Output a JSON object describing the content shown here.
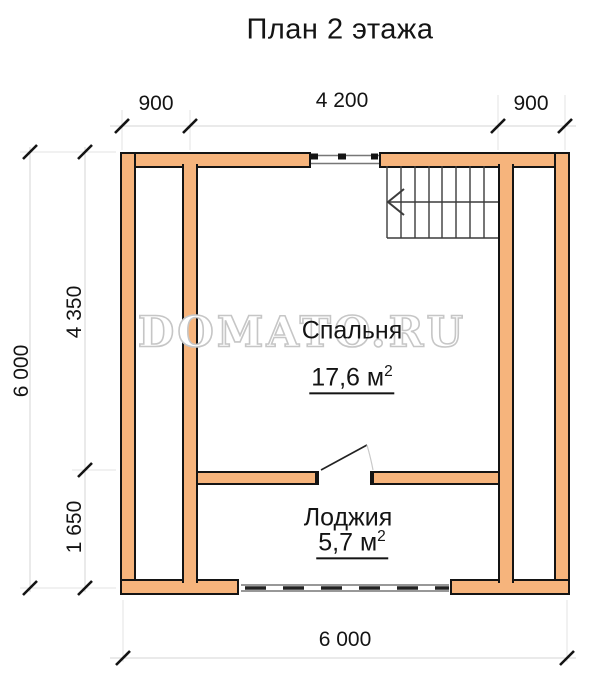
{
  "title": "План 2 этажа",
  "watermark": "DOMATO.RU",
  "plan": {
    "rooms": [
      {
        "name": "Спальня",
        "area": "17,6 м",
        "area_sup": "2"
      },
      {
        "name": "Лоджия",
        "area": "5,7 м",
        "area_sup": "2"
      }
    ],
    "dimensions": {
      "top_left": "900",
      "top_middle": "4 200",
      "top_right": "900",
      "left_total": "6 000",
      "left_upper": "4 350",
      "left_lower": "1 650",
      "bottom_total": "6 000"
    }
  },
  "colors": {
    "wall_fill": "#f6b47c",
    "wall_outline": "#141414",
    "dim_line": "#d6d6d6",
    "extension_line": "#e3e3e3",
    "tick": "#141414",
    "stairs_line": "#3c3c3c",
    "watermark_outline": "#c6c6c6",
    "text": "#141414"
  }
}
